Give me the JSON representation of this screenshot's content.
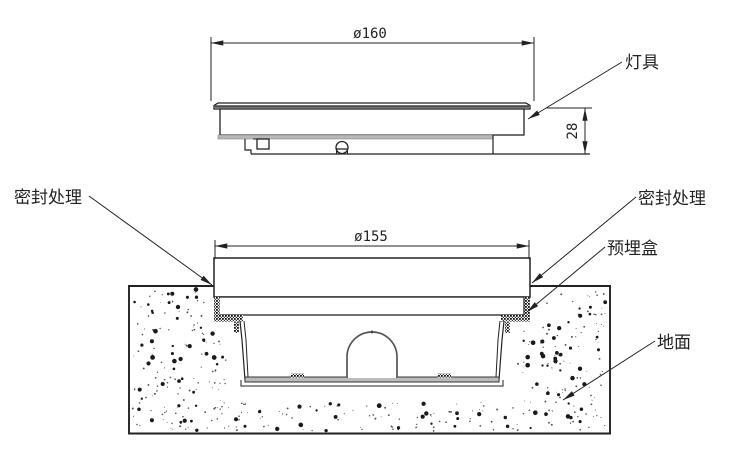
{
  "drawing": {
    "top_view": {
      "diameter_label": "ø160",
      "height_label": "28",
      "luminaire_label": "灯具"
    },
    "section_view": {
      "diameter_label": "ø155",
      "seal_left_label": "密封处理",
      "seal_right_label": "密封处理",
      "embedded_box_label": "预埋盒",
      "ground_label": "地面"
    },
    "colors": {
      "line": "#222222",
      "background": "#ffffff",
      "fixture_underside": "#b8b8b8",
      "seal_hatch": "#111111"
    }
  }
}
